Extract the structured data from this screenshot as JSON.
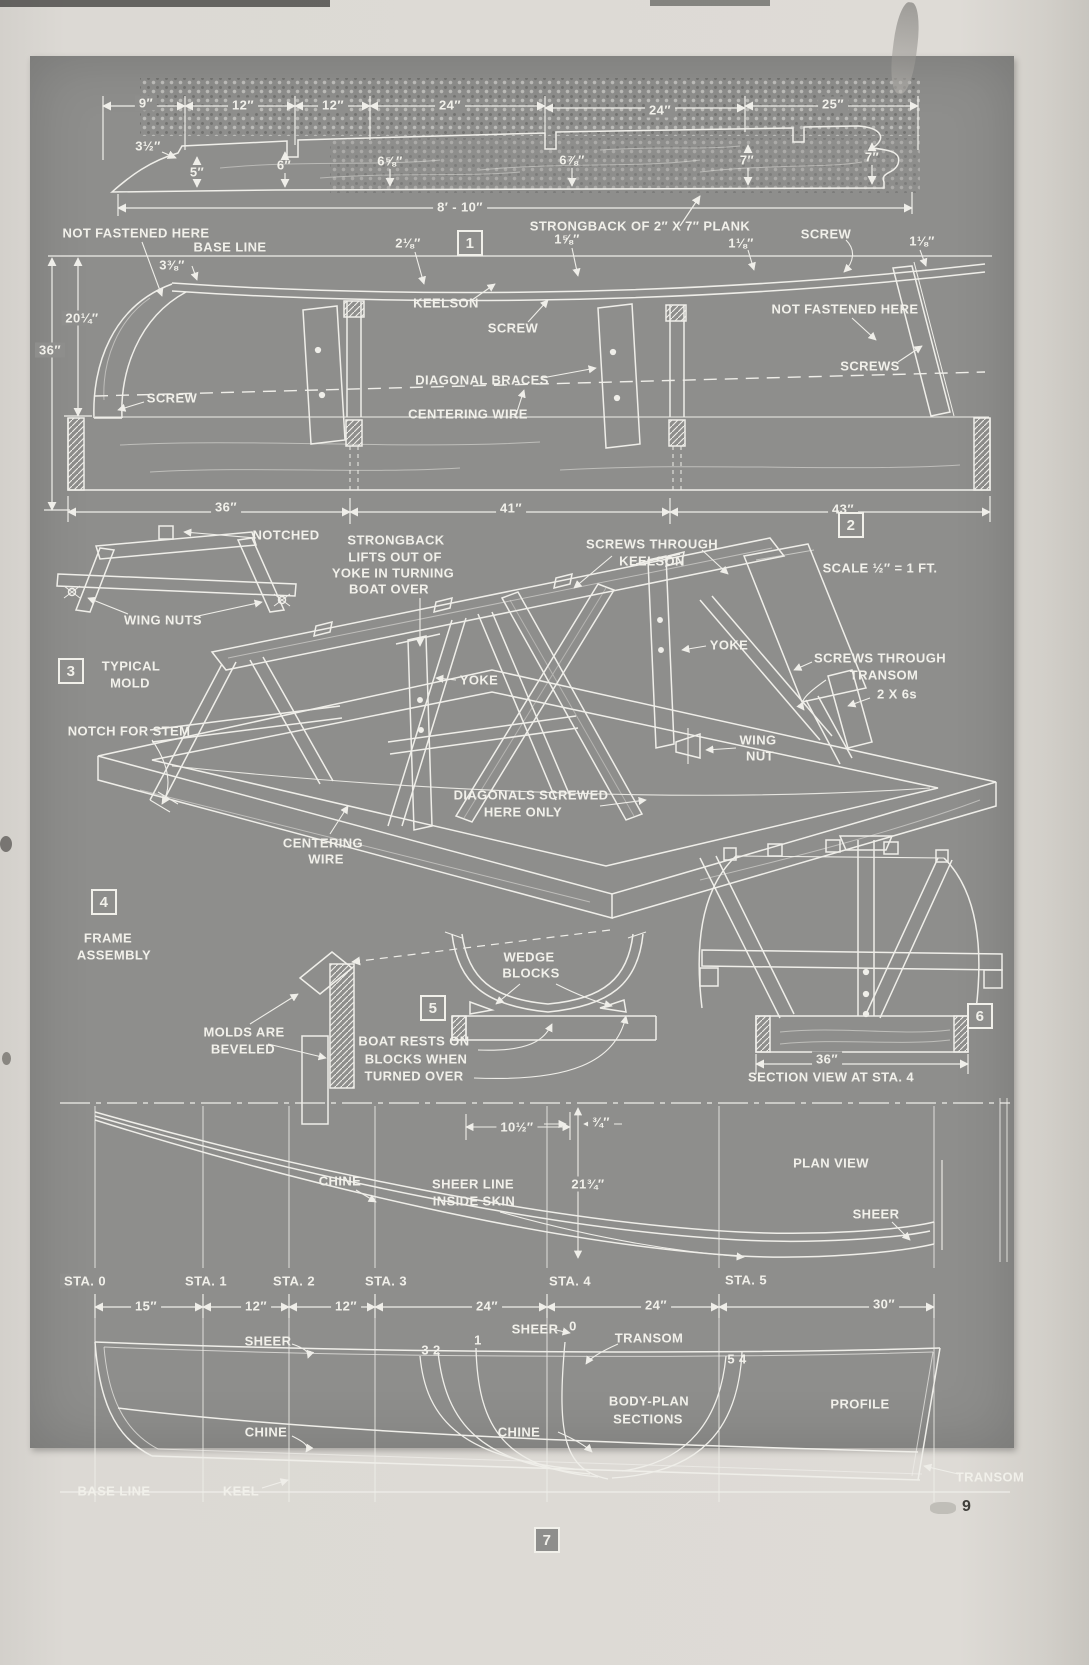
{
  "page": {
    "number": "9"
  },
  "colors": {
    "plate": "#8e8e8c",
    "ink": "#f1f0ea",
    "paper": "#dcd9d4"
  },
  "figures": {
    "fig1_strongback_plank": {
      "labels": [
        {
          "name": "dim-9",
          "text": "9″",
          "x": 146,
          "y": 103,
          "bg": true
        },
        {
          "name": "dim-12-a",
          "text": "12″",
          "x": 243,
          "y": 105,
          "bg": true
        },
        {
          "name": "dim-12-b",
          "text": "12″",
          "x": 333,
          "y": 105,
          "bg": true
        },
        {
          "name": "dim-24-a",
          "text": "24″",
          "x": 450,
          "y": 105,
          "bg": true
        },
        {
          "name": "dim-24-b",
          "text": "24″",
          "x": 660,
          "y": 110,
          "bg": true
        },
        {
          "name": "dim-25",
          "text": "25″",
          "x": 833,
          "y": 104,
          "bg": true
        },
        {
          "name": "height-3-1-2",
          "text": "3½″",
          "x": 148,
          "y": 146
        },
        {
          "name": "height-5",
          "text": "5″",
          "x": 197,
          "y": 172
        },
        {
          "name": "height-6",
          "text": "6″",
          "x": 284,
          "y": 165
        },
        {
          "name": "height-6-5-8",
          "text": "6⅝″",
          "x": 390,
          "y": 161
        },
        {
          "name": "height-6-7-8",
          "text": "6⅞″",
          "x": 572,
          "y": 160
        },
        {
          "name": "height-7-a",
          "text": "7″",
          "x": 747,
          "y": 160
        },
        {
          "name": "height-7-b",
          "text": "7″",
          "x": 872,
          "y": 157
        },
        {
          "name": "dim-8ft-10in",
          "text": "8′ - 10″",
          "x": 460,
          "y": 207,
          "bg": true
        },
        {
          "name": "strongback-title",
          "text": "STRONGBACK OF 2″ X 7″ PLANK",
          "x": 640,
          "y": 226
        },
        {
          "name": "figure-box-1",
          "text": "1",
          "x": 470,
          "y": 243,
          "boxed": true
        }
      ]
    },
    "fig2_side_setup": {
      "labels": [
        {
          "name": "not-fastened-left",
          "text": "NOT FASTENED HERE",
          "x": 136,
          "y": 233
        },
        {
          "name": "base-line-label",
          "text": "BASE LINE",
          "x": 230,
          "y": 247
        },
        {
          "name": "dim-2-1-8",
          "text": "2⅛″",
          "x": 408,
          "y": 243
        },
        {
          "name": "dim-1-5-8",
          "text": "1⅝″",
          "x": 567,
          "y": 239
        },
        {
          "name": "dim-1-1-8-a",
          "text": "1⅛″",
          "x": 741,
          "y": 243
        },
        {
          "name": "screw-top",
          "text": "SCREW",
          "x": 826,
          "y": 234
        },
        {
          "name": "dim-1-1-8-b",
          "text": "1⅛″",
          "x": 922,
          "y": 241
        },
        {
          "name": "height-3-3-8",
          "text": "3⅜″",
          "x": 172,
          "y": 265
        },
        {
          "name": "height-20-1-4",
          "text": "20¼″",
          "x": 82,
          "y": 318,
          "bg": true
        },
        {
          "name": "height-36",
          "text": "36″",
          "x": 50,
          "y": 350,
          "bg": true
        },
        {
          "name": "screw-stem",
          "text": "SCREW",
          "x": 172,
          "y": 398
        },
        {
          "name": "keelson-label",
          "text": "KEELSON",
          "x": 446,
          "y": 303
        },
        {
          "name": "screw-keelson",
          "text": "SCREW",
          "x": 513,
          "y": 328
        },
        {
          "name": "diagonal-braces",
          "text": "DIAGONAL BRACES",
          "x": 482,
          "y": 380
        },
        {
          "name": "centering-wire-a",
          "text": "CENTERING WIRE",
          "x": 468,
          "y": 414
        },
        {
          "name": "not-fastened-right",
          "text": "NOT FASTENED HERE",
          "x": 845,
          "y": 309
        },
        {
          "name": "screws-right",
          "text": "SCREWS",
          "x": 870,
          "y": 366
        },
        {
          "name": "dim-36-a",
          "text": "36″",
          "x": 226,
          "y": 507,
          "bg": true
        },
        {
          "name": "dim-41",
          "text": "41″",
          "x": 511,
          "y": 508,
          "bg": true
        },
        {
          "name": "dim-43",
          "text": "43″",
          "x": 843,
          "y": 509,
          "bg": true
        },
        {
          "name": "figure-box-2",
          "text": "2",
          "x": 851,
          "y": 525,
          "boxed": true
        },
        {
          "name": "scale-note",
          "text": "SCALE ½″ = 1 FT.",
          "x": 880,
          "y": 568
        }
      ]
    },
    "fig3_typical_mold": {
      "labels": [
        {
          "name": "notched",
          "text": "NOTCHED",
          "x": 286,
          "y": 535
        },
        {
          "name": "wing-nuts",
          "text": "WING NUTS",
          "x": 163,
          "y": 620
        },
        {
          "name": "figure-box-3",
          "text": "3",
          "x": 71,
          "y": 671,
          "boxed": true
        },
        {
          "name": "typical-mold-line1",
          "text": "TYPICAL",
          "x": 131,
          "y": 666
        },
        {
          "name": "typical-mold-line2",
          "text": "MOLD",
          "x": 130,
          "y": 683
        }
      ]
    },
    "fig4_frame_assembly": {
      "labels": [
        {
          "name": "lifts-line1",
          "text": "STRONGBACK",
          "x": 396,
          "y": 540
        },
        {
          "name": "lifts-line2",
          "text": "LIFTS OUT OF",
          "x": 395,
          "y": 557
        },
        {
          "name": "lifts-line3",
          "text": "YOKE IN TURNING",
          "x": 393,
          "y": 573
        },
        {
          "name": "lifts-line4",
          "text": "BOAT OVER",
          "x": 389,
          "y": 589
        },
        {
          "name": "screws-keelson-line1",
          "text": "SCREWS THROUGH",
          "x": 652,
          "y": 544
        },
        {
          "name": "screws-keelson-line2",
          "text": "KEELSON",
          "x": 652,
          "y": 561
        },
        {
          "name": "yoke-a",
          "text": "YOKE",
          "x": 729,
          "y": 645
        },
        {
          "name": "screws-transom-line1",
          "text": "SCREWS THROUGH",
          "x": 880,
          "y": 658
        },
        {
          "name": "screws-transom-line2",
          "text": "TRANSOM",
          "x": 884,
          "y": 675
        },
        {
          "name": "two-by-sixes",
          "text": "2 X 6s",
          "x": 897,
          "y": 694
        },
        {
          "name": "notch-for-stem",
          "text": "NOTCH FOR STEM",
          "x": 129,
          "y": 731
        },
        {
          "name": "yoke-b",
          "text": "YOKE",
          "x": 479,
          "y": 680
        },
        {
          "name": "wing-nut-line1",
          "text": "WING",
          "x": 758,
          "y": 740
        },
        {
          "name": "wing-nut-line2",
          "text": "NUT",
          "x": 760,
          "y": 756
        },
        {
          "name": "diagonals-line1",
          "text": "DIAGONALS SCREWED",
          "x": 531,
          "y": 795
        },
        {
          "name": "diagonals-line2",
          "text": "HERE ONLY",
          "x": 523,
          "y": 812
        },
        {
          "name": "centering-wire-b1",
          "text": "CENTERING",
          "x": 323,
          "y": 843
        },
        {
          "name": "centering-wire-b2",
          "text": "WIRE",
          "x": 326,
          "y": 859
        },
        {
          "name": "figure-box-4",
          "text": "4",
          "x": 104,
          "y": 902,
          "boxed": true
        },
        {
          "name": "frame-assembly-line1",
          "text": "FRAME",
          "x": 108,
          "y": 938
        },
        {
          "name": "frame-assembly-line2",
          "text": "ASSEMBLY",
          "x": 114,
          "y": 955
        }
      ]
    },
    "fig5_boat_on_blocks": {
      "labels": [
        {
          "name": "wedge-line1",
          "text": "WEDGE",
          "x": 529,
          "y": 957
        },
        {
          "name": "wedge-line2",
          "text": "BLOCKS",
          "x": 531,
          "y": 973
        },
        {
          "name": "figure-box-5",
          "text": "5",
          "x": 433,
          "y": 1008,
          "boxed": true
        },
        {
          "name": "molds-beveled-line1",
          "text": "MOLDS ARE",
          "x": 244,
          "y": 1032
        },
        {
          "name": "molds-beveled-line2",
          "text": "BEVELED",
          "x": 243,
          "y": 1049
        },
        {
          "name": "boat-rests-line1",
          "text": "BOAT RESTS ON",
          "x": 414,
          "y": 1041
        },
        {
          "name": "boat-rests-line2",
          "text": "BLOCKS WHEN",
          "x": 416,
          "y": 1059
        },
        {
          "name": "boat-rests-line3",
          "text": "TURNED OVER",
          "x": 414,
          "y": 1076
        }
      ]
    },
    "fig6_section_sta4": {
      "labels": [
        {
          "name": "figure-box-6",
          "text": "6",
          "x": 980,
          "y": 1016,
          "boxed": true
        },
        {
          "name": "dim-36-b",
          "text": "36″",
          "x": 827,
          "y": 1059,
          "bg": true
        },
        {
          "name": "section-view-caption",
          "text": "SECTION VIEW AT STA. 4",
          "x": 831,
          "y": 1077
        }
      ]
    },
    "fig7_lines_plan": {
      "labels": [
        {
          "name": "dim-10-1-2",
          "text": "10½″",
          "x": 517,
          "y": 1127,
          "bg": true
        },
        {
          "name": "dim-3-4",
          "text": "¾″",
          "x": 601,
          "y": 1122,
          "bg": true
        },
        {
          "name": "dim-21-3-4",
          "text": "21¾″",
          "x": 588,
          "y": 1184,
          "bg": true
        },
        {
          "name": "chine-plan",
          "text": "CHINE",
          "x": 340,
          "y": 1181
        },
        {
          "name": "sheer-line-line1",
          "text": "SHEER LINE",
          "x": 473,
          "y": 1184
        },
        {
          "name": "sheer-line-line2",
          "text": "INSIDE SKIN",
          "x": 474,
          "y": 1201
        },
        {
          "name": "plan-view",
          "text": "PLAN VIEW",
          "x": 831,
          "y": 1163
        },
        {
          "name": "sheer-plan",
          "text": "SHEER",
          "x": 876,
          "y": 1214
        },
        {
          "name": "sta-0",
          "text": "STA. 0",
          "x": 85,
          "y": 1281,
          "bg": true
        },
        {
          "name": "sta-1",
          "text": "STA. 1",
          "x": 206,
          "y": 1281,
          "bg": true
        },
        {
          "name": "sta-2",
          "text": "STA. 2",
          "x": 294,
          "y": 1281,
          "bg": true
        },
        {
          "name": "sta-3",
          "text": "STA. 3",
          "x": 386,
          "y": 1281,
          "bg": true
        },
        {
          "name": "sta-4",
          "text": "STA. 4",
          "x": 570,
          "y": 1281,
          "bg": true
        },
        {
          "name": "sta-5",
          "text": "STA. 5",
          "x": 746,
          "y": 1280,
          "bg": true
        },
        {
          "name": "dim-15",
          "text": "15″",
          "x": 146,
          "y": 1306,
          "bg": true
        },
        {
          "name": "dim-12-c",
          "text": "12″",
          "x": 256,
          "y": 1306,
          "bg": true
        },
        {
          "name": "dim-12-d",
          "text": "12″",
          "x": 346,
          "y": 1306,
          "bg": true
        },
        {
          "name": "dim-24-c",
          "text": "24″",
          "x": 487,
          "y": 1306,
          "bg": true
        },
        {
          "name": "dim-24-d",
          "text": "24″",
          "x": 656,
          "y": 1305,
          "bg": true
        },
        {
          "name": "dim-30",
          "text": "30″",
          "x": 884,
          "y": 1304,
          "bg": true
        },
        {
          "name": "sheer-bodyplan",
          "text": "SHEER",
          "x": 535,
          "y": 1329
        },
        {
          "name": "section-num-0",
          "text": "0",
          "x": 573,
          "y": 1326
        },
        {
          "name": "transom-bodyplan",
          "text": "TRANSOM",
          "x": 649,
          "y": 1338
        },
        {
          "name": "section-num-1",
          "text": "1",
          "x": 478,
          "y": 1340
        },
        {
          "name": "section-num-3-2",
          "text": "3  2",
          "x": 431,
          "y": 1350
        },
        {
          "name": "sheer-profile",
          "text": "SHEER",
          "x": 268,
          "y": 1341
        },
        {
          "name": "section-num-5-4",
          "text": "5 4",
          "x": 737,
          "y": 1359
        },
        {
          "name": "chine-profile",
          "text": "CHINE",
          "x": 266,
          "y": 1432
        },
        {
          "name": "chine-bodyplan",
          "text": "CHINE",
          "x": 519,
          "y": 1432
        },
        {
          "name": "body-plan-line1",
          "text": "BODY-PLAN",
          "x": 649,
          "y": 1401
        },
        {
          "name": "body-plan-line2",
          "text": "SECTIONS",
          "x": 648,
          "y": 1419
        },
        {
          "name": "profile-label",
          "text": "PROFILE",
          "x": 860,
          "y": 1404
        },
        {
          "name": "transom-profile",
          "text": "TRANSOM",
          "x": 990,
          "y": 1477
        },
        {
          "name": "base-line-2",
          "text": "BASE LINE",
          "x": 114,
          "y": 1491
        },
        {
          "name": "keel-label",
          "text": "KEEL",
          "x": 241,
          "y": 1491
        },
        {
          "name": "figure-box-7",
          "text": "7",
          "x": 547,
          "y": 1540,
          "boxed": true
        }
      ]
    }
  }
}
